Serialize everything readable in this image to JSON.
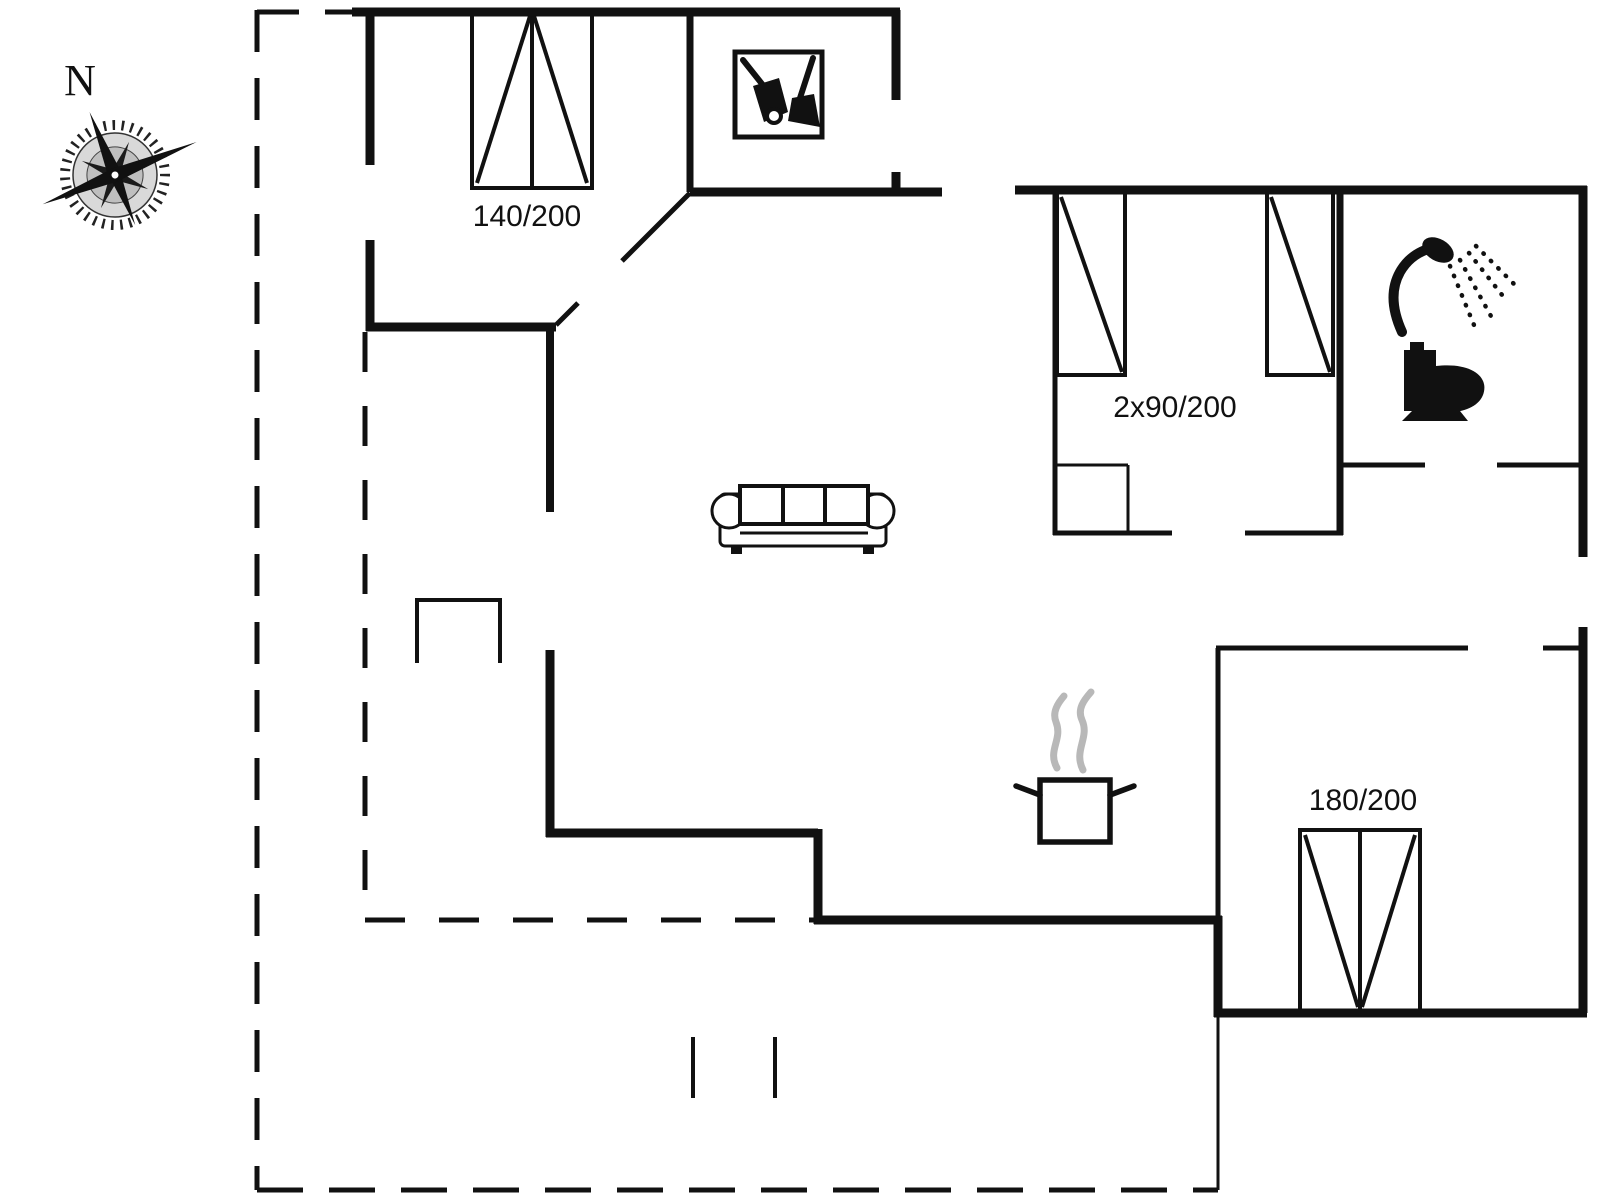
{
  "page": {
    "type": "floor-plan",
    "background": "#ffffff",
    "line_color": "#111111",
    "steam_color": "#b8b8b8"
  },
  "compass": {
    "north_label": "N"
  },
  "labels": {
    "bed_double_top": "140/200",
    "beds_twin_right": "2x90/200",
    "bed_double_bottom": "180/200"
  },
  "icons": {
    "compass_rose": "compass-rose-icon",
    "cleaning_closet": "vacuum-broom-icon",
    "shower": "shower-icon",
    "toilet": "toilet-icon",
    "cooking_pot": "cooking-pot-icon",
    "sofa": "sofa-topview",
    "fireplace": "fireplace-outline"
  }
}
